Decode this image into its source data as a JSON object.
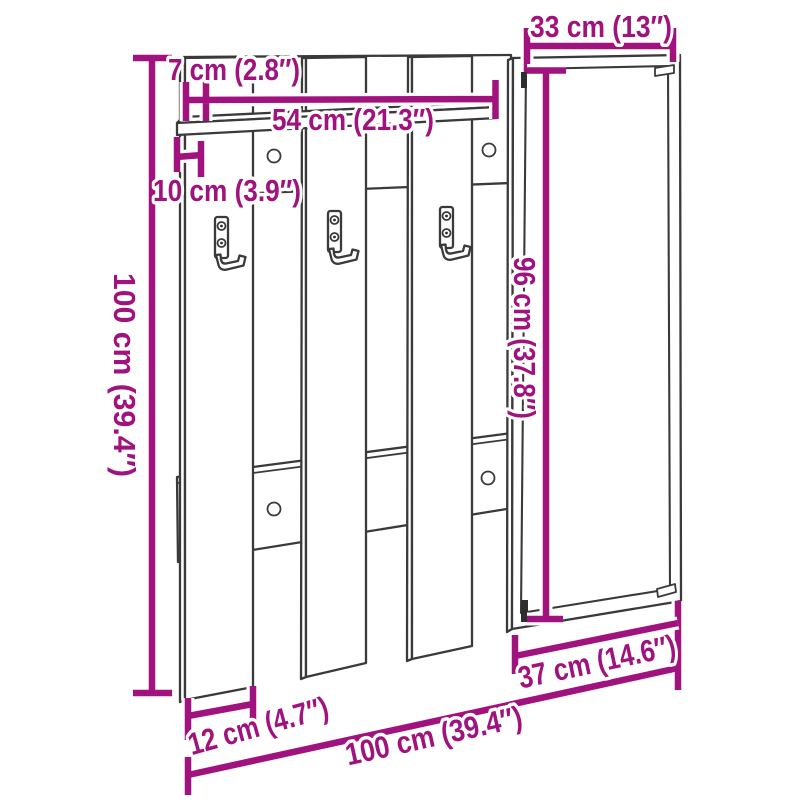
{
  "colors": {
    "dimension": "#A0127D",
    "outline": "#3A3A3A",
    "bracket_dark": "#2E2E2E",
    "background": "#FFFFFF"
  },
  "diagram": {
    "labels": {
      "top_width": "33 cm (13″)",
      "shelf_depth": "7 cm (2.8″)",
      "shelf_width": "54 cm (21.3″)",
      "shelf_offset": "10 cm (3.9″)",
      "total_height": "100 cm (39.4″)",
      "mirror_height": "96 cm (37.8″)",
      "slat_width": "12 cm (4.7″)",
      "total_width": "100 cm (39.4″)",
      "mirror_width": "37 cm (14.6″)"
    }
  }
}
